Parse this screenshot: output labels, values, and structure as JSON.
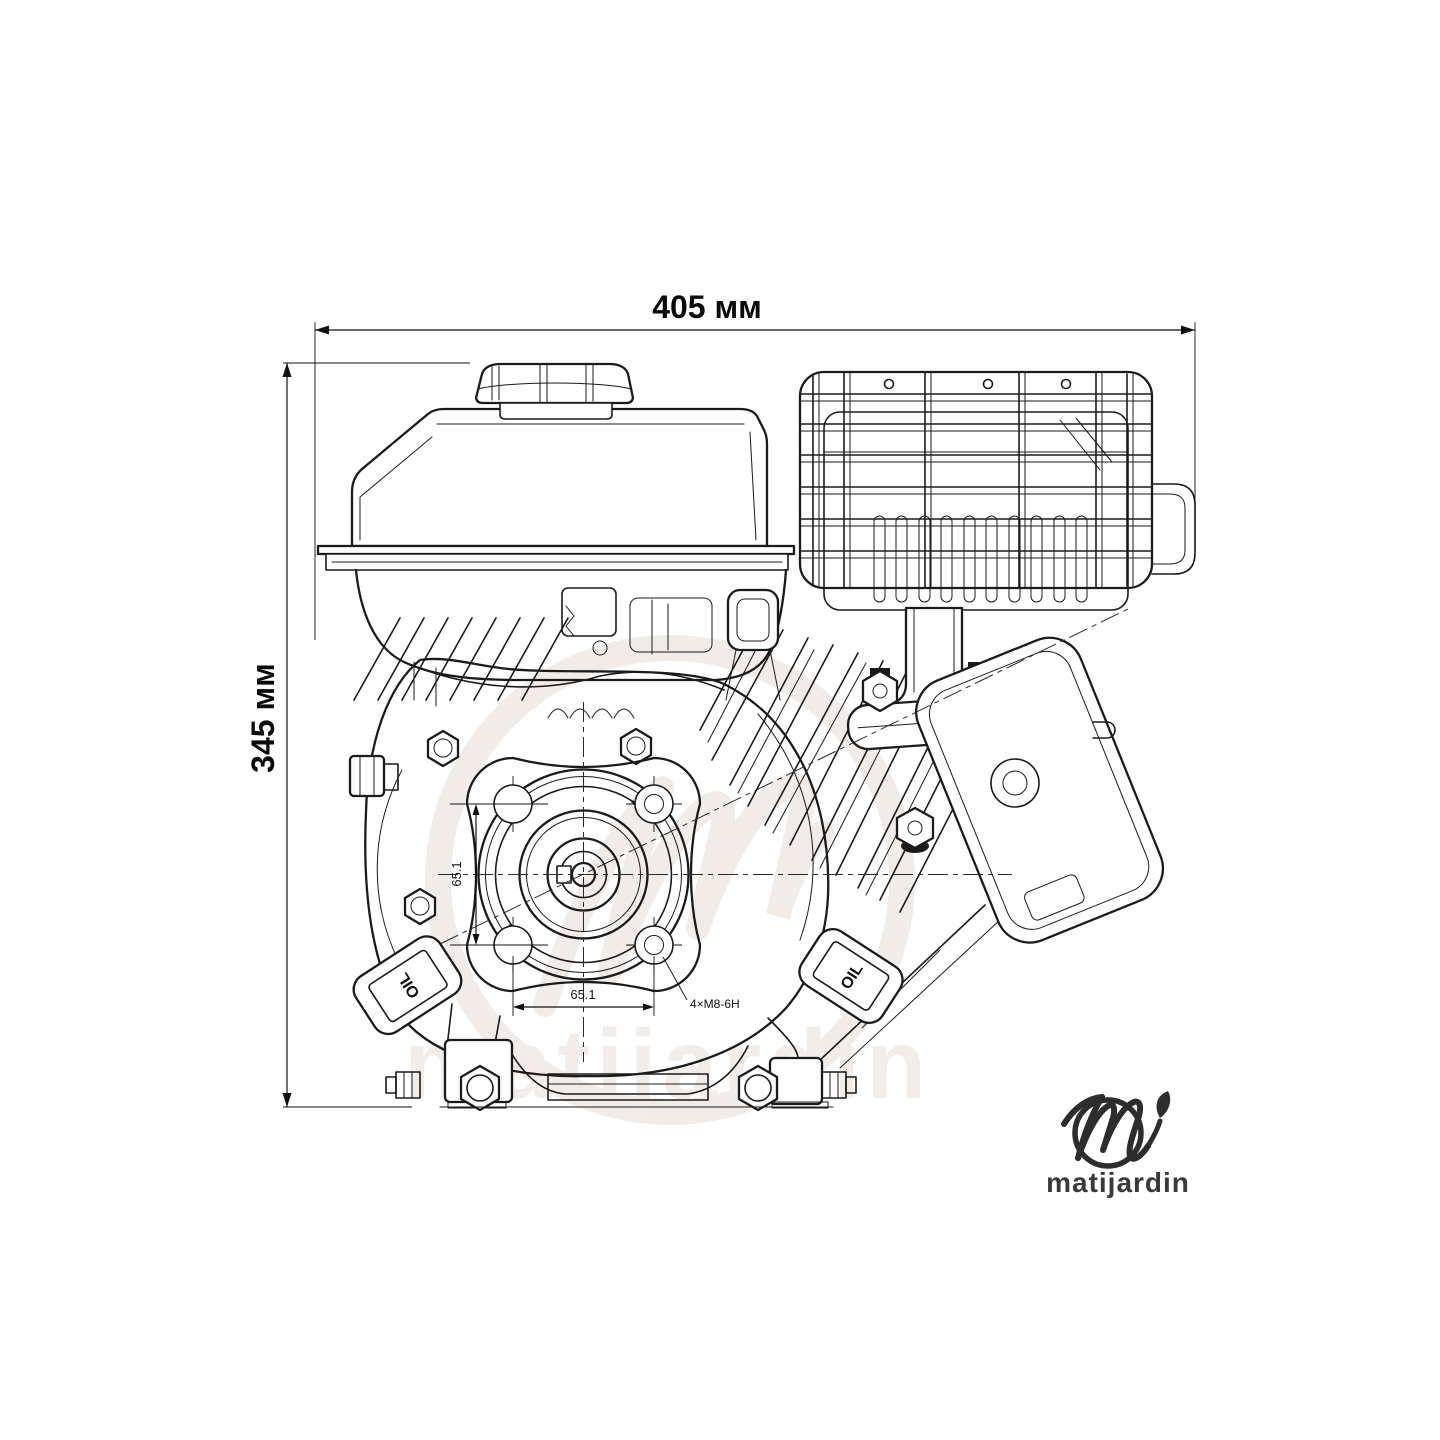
{
  "canvas": {
    "width": 1440,
    "height": 1440,
    "background": "#ffffff"
  },
  "annotations": {
    "width_dimension": {
      "label": "405 мм"
    },
    "height_dimension": {
      "label": "345 мм"
    },
    "flange_vertical_dimension": {
      "label": "65.1"
    },
    "flange_horizontal_dimension": {
      "label": "65.1"
    },
    "bolt_pattern": {
      "label": "4×M8-6H"
    }
  },
  "engine": {
    "oil_caps": [
      {
        "label": "OIL"
      },
      {
        "label": "OIL"
      }
    ]
  },
  "watermark": {
    "text": "matijardin"
  },
  "brand": {
    "name": "matijardin"
  },
  "colors": {
    "line": "#1b1b1b",
    "dimension_text": "#0a0a0a",
    "watermark": "#f1ece8",
    "logo": "#2d2d2d"
  }
}
